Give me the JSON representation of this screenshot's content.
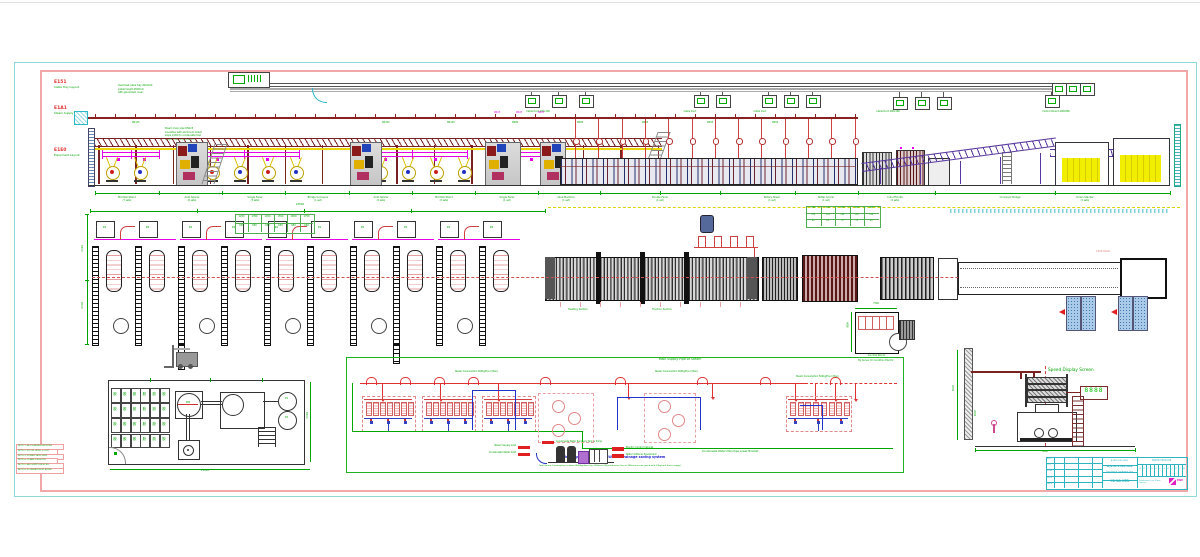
{
  "drawing": {
    "top_band": {
      "side_labels": [
        {
          "code": "E151",
          "text": "Cable Tray Layout"
        },
        {
          "code": "E1A1",
          "text": "Steam Supply"
        },
        {
          "code": "E1E0",
          "text": "Equipment Layout"
        }
      ],
      "note_block1": [
        "Overhead cable tray 200x100",
        "install height 4500mm",
        "with galvanized cover"
      ],
      "note_block2": [
        "Steam main pipe DN125",
        "insulation with aluminum jacket",
        "slope 1/200 to condensate trap",
        "support spacing 2000mm"
      ],
      "cable_labels": [
        {
          "x": 538,
          "text": "Cable Duct 200x100"
        },
        {
          "x": 690,
          "text": "Cable Duct"
        },
        {
          "x": 760,
          "text": "Cable Duct"
        },
        {
          "x": 888,
          "text": "Cable Duct 200x100"
        },
        {
          "x": 1056,
          "text": "Control Panel 1200x800"
        }
      ],
      "pipe_labels": [
        {
          "x": 140,
          "text": "DN125"
        },
        {
          "x": 390,
          "text": "DN100"
        },
        {
          "x": 455,
          "text": "DN100"
        },
        {
          "x": 520,
          "text": "DN80"
        },
        {
          "x": 585,
          "text": "DN80"
        },
        {
          "x": 650,
          "text": "DN65"
        },
        {
          "x": 715,
          "text": "DN65"
        },
        {
          "x": 780,
          "text": "DN50"
        }
      ],
      "riser_labels": [
        {
          "x": 500,
          "text": "DN25"
        },
        {
          "x": 522,
          "text": "DN25"
        },
        {
          "x": 544,
          "text": "DN25"
        }
      ],
      "machine_labels": [
        {
          "x": 127,
          "text": "Mill Roll Stand",
          "sub": "(7 sets)"
        },
        {
          "x": 192,
          "text": "Auto Splicer",
          "sub": "(6 sets)"
        },
        {
          "x": 255,
          "text": "Single Facer",
          "sub": "(3 sets)"
        },
        {
          "x": 318,
          "text": "Bridge Conveyor",
          "sub": "(1 set)"
        },
        {
          "x": 381,
          "text": "Auto Splicer",
          "sub": "(2 sets)"
        },
        {
          "x": 444,
          "text": "Mill Roll Stand",
          "sub": "(2 sets)"
        },
        {
          "x": 507,
          "text": "Single Facer",
          "sub": "(1 set)"
        },
        {
          "x": 566,
          "text": "Glue Machine",
          "sub": "(1 set)"
        },
        {
          "x": 660,
          "text": "Double Facer",
          "sub": "(1 set)"
        },
        {
          "x": 772,
          "text": "Rotary Shear",
          "sub": "(1 set)"
        },
        {
          "x": 826,
          "text": "Slitter Scorer",
          "sub": "(1 set)"
        },
        {
          "x": 895,
          "text": "Cut-off Knife",
          "sub": "(2 sets)"
        },
        {
          "x": 1010,
          "text": "Conveyor Bridge",
          "sub": ""
        },
        {
          "x": 1085,
          "text": "Down Stacker",
          "sub": "(2 sets)"
        }
      ]
    },
    "middle_band": {
      "dim_top": "24500",
      "dim_left": [
        "5500",
        "8000"
      ],
      "box_label": "RS",
      "table1_values": [
        "1250",
        "1350",
        "1450",
        "1550",
        "1650",
        "1750",
        "650",
        "650",
        "650",
        "650",
        "650",
        "650"
      ],
      "table2_values": [
        "280",
        "300",
        "320",
        "340",
        "360",
        "120",
        "130",
        "140",
        "150",
        "160",
        "60",
        "65",
        "70",
        "75",
        "80"
      ],
      "pallet_label": "1400 Pallet",
      "dryer_labels": [
        "Heating Section",
        "Traction Section"
      ],
      "control_room": {
        "code": "TRE0512",
        "line1": "Control Room",
        "line2": "By Server Or Condition Electric"
      },
      "dim_cr_top": "7500",
      "dim_cr_left": "4800"
    },
    "t5": {
      "title": "T5 Glue Making System",
      "cell_glyph": "胶",
      "mixer_label": "MIX",
      "storage_label": "Glue Storage Tank",
      "pump_labels": [
        "P1",
        "P2"
      ],
      "pump_tag": "P-01",
      "dim_right": "6500",
      "dim_bottom": "21000"
    },
    "schematic": {
      "title": "Main Supply Pipe of Steam",
      "steam_labels": [
        "Steam Consumption 900kg/Hour (Max)",
        "Steam Consumption 900kg/Hour (Max)",
        "Steam Consumption 500kg/Hour (Max)"
      ],
      "condensate_label": "Condensate Water Main Pipe Lower Bracket",
      "left_tags": [
        "Steam Supply Inlet",
        "Condensate Water Inlet"
      ],
      "right_tags": [
        "Electric Control Cabinet",
        "Water Softener Equipment"
      ],
      "top_tag": "Condensate Water Recovery Tank & Pump",
      "headline": "Intelligent Condensate Water Drainage saving system",
      "footnote": "Total Steam Consumption is about 4000kg/Hour (by 2500mm 5Ply production line at 180m/min max speed with 13kg/cm2 boiler supply)"
    },
    "speed": {
      "title": "Speed Display Screen",
      "value": "8888",
      "dim_v": "4500",
      "dim_v2": "2600",
      "dim_h": "9000"
    },
    "title_block": {
      "left_rows": [
        "REV",
        "QTY",
        "ZONE",
        "SIGN",
        "DATE"
      ],
      "mid_l1": "ACAD-2006 DWG",
      "mid_l2": "WJ250-2500-5LB",
      "mid_l3": "Corrugated Cardboard Line",
      "mid_l4": "YB-2A-VER",
      "right_l1": "WJ250-2500-2-B",
      "right_cells": [
        "A",
        "B",
        "C",
        "D",
        "E",
        "F",
        "G",
        "H",
        "J",
        "K",
        "L",
        "M"
      ],
      "right_l3": "Production Line Plane Layout",
      "logo_text": "MW"
    },
    "notes": {
      "rows": [
        "NOTE 1: ALL DIMENSIONS IN MM",
        "NOTE 2: FLOOR LEVEL +-0.00",
        "NOTE 3: POWER 380V 50HZ",
        "NOTE 4: STEAM 13KG/CM2",
        "NOTE 5: AIR SUPPLY 8KG/CM2",
        "NOTE 6: FOUNDATION BY BUYER"
      ]
    }
  }
}
